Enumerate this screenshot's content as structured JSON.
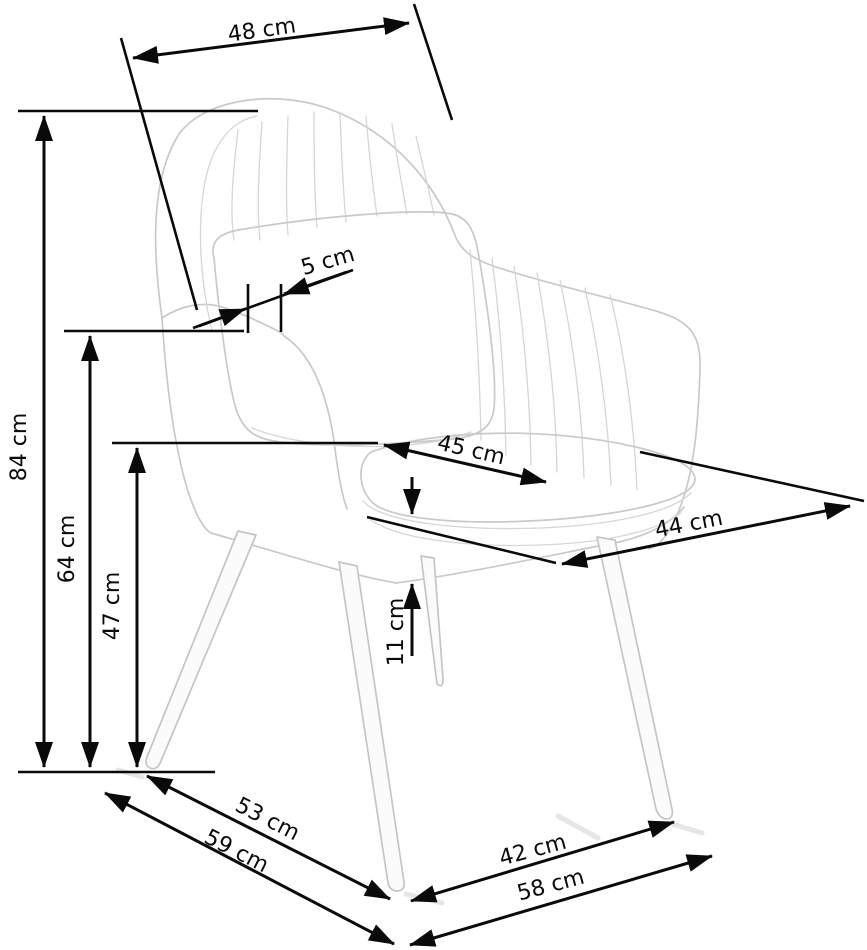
{
  "page": {
    "background": "#ffffff"
  },
  "diagram": {
    "subject": "armchair dimension drawing",
    "unit": "cm",
    "dimension_line_color": "#0a0a0a",
    "chair_outline_color": "#c9c9c9",
    "dimensions": [
      {
        "id": "dim-48",
        "label": "48 cm",
        "value": 48,
        "unit": "cm",
        "placement": "top-diagonal"
      },
      {
        "id": "dim-84",
        "label": "84 cm",
        "value": 84,
        "unit": "cm",
        "placement": "left-vertical-outer"
      },
      {
        "id": "dim-64",
        "label": "64 cm",
        "value": 64,
        "unit": "cm",
        "placement": "left-vertical-middle"
      },
      {
        "id": "dim-47",
        "label": "47 cm",
        "value": 47,
        "unit": "cm",
        "placement": "left-vertical-inner"
      },
      {
        "id": "dim-5",
        "label": "5 cm",
        "value": 5,
        "unit": "cm",
        "placement": "pillow-diagonal"
      },
      {
        "id": "dim-45",
        "label": "45 cm",
        "value": 45,
        "unit": "cm",
        "placement": "seat-diagonal"
      },
      {
        "id": "dim-44",
        "label": "44 cm",
        "value": 44,
        "unit": "cm",
        "placement": "right-diagonal"
      },
      {
        "id": "dim-11",
        "label": "11 cm",
        "value": 11,
        "unit": "cm",
        "placement": "center-vertical"
      },
      {
        "id": "dim-53",
        "label": "53 cm",
        "value": 53,
        "unit": "cm",
        "placement": "bottom-left-diagonal-upper"
      },
      {
        "id": "dim-59",
        "label": "59 cm",
        "value": 59,
        "unit": "cm",
        "placement": "bottom-left-diagonal-lower"
      },
      {
        "id": "dim-42",
        "label": "42 cm",
        "value": 42,
        "unit": "cm",
        "placement": "bottom-right-diagonal-upper"
      },
      {
        "id": "dim-58",
        "label": "58 cm",
        "value": 58,
        "unit": "cm",
        "placement": "bottom-right-diagonal-lower"
      }
    ]
  }
}
